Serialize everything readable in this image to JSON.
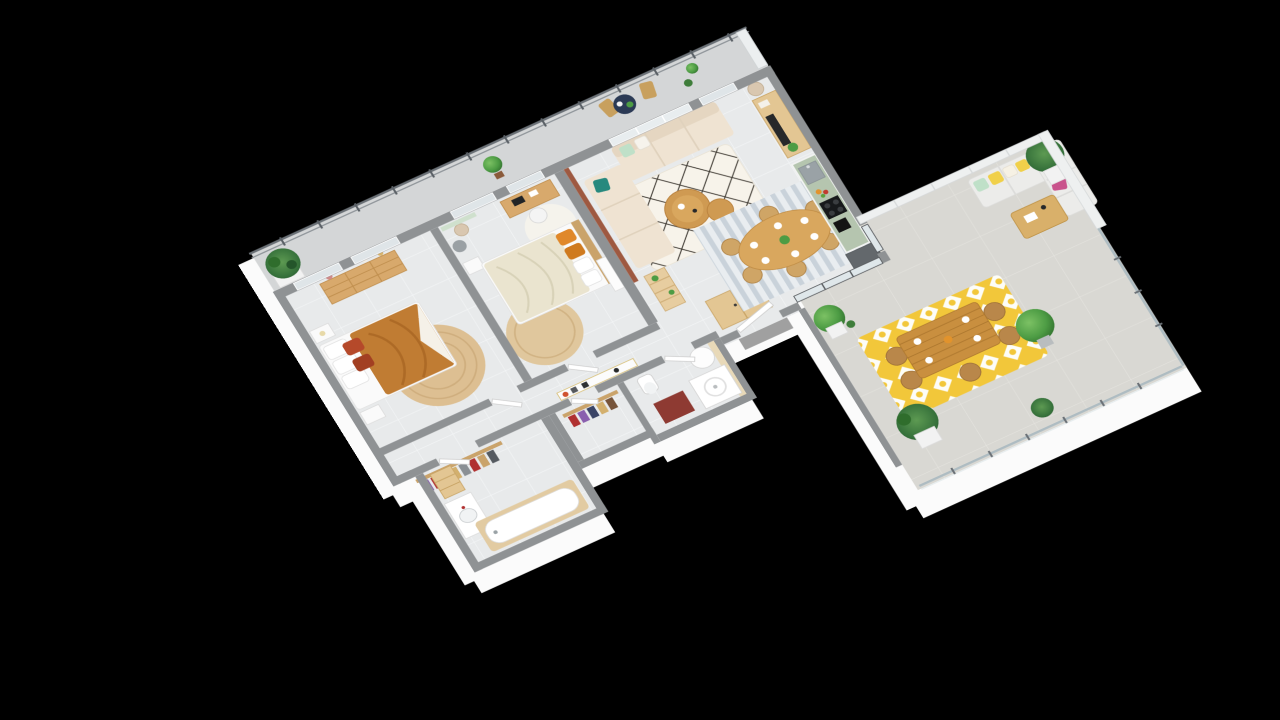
{
  "scene": {
    "type": "isometric-3d-floor-plan",
    "description": "3D rendered floor plan of a three-bedroom apartment with balcony and large terrace on a black background",
    "background": "#000000"
  },
  "palette": {
    "background": "#000000",
    "wallTop": "#8f9294",
    "wallFace": "#fbfbfb",
    "accentWall": "#9e5941",
    "floorMain": "#e8eaeb",
    "floorBalcony": "#d4d6d7",
    "floorTerrace": "#d9d8d3",
    "glass": "#dfe7ea",
    "railingMetal": "#6a7076",
    "screenWhite": "#eef0f0",
    "woodMain": "#d8a96c",
    "woodLight": "#e3c693",
    "woodTable": "#cf9a52",
    "sofaCream": "#efe3d2",
    "outdoorSofa": "#ececea",
    "bedCaramel": "#c07c33",
    "bedLinen": "#eae4cf",
    "pillowRust": "#b5492a",
    "pillowOrange": "#e0882a",
    "pillowTeal": "#27897e",
    "pillowMint": "#bfe0c8",
    "pillowMagenta": "#c9538c",
    "pillowYellow": "#f0d04a",
    "rugJute": "#ddbf92",
    "rugBerber": "#f7f3ea",
    "rugBerberLine": "#332e27",
    "rugStripeA": "#c9d2da",
    "rugStripeB": "#e9edf0",
    "rugYellow": "#f2c73a",
    "kitchenGreen": "#b5c5af",
    "steel": "#9aa2a6",
    "applianceDark": "#17191b",
    "fridgeGray": "#63686c",
    "matRed": "#8e3a32",
    "tileBeige": "#e8d9b8",
    "plantGreen": "#4d9c44",
    "plantDark": "#2f6d2c",
    "potWhite": "#f2f2f2",
    "doormatGray": "#a0a0a0"
  },
  "rooms": [
    {
      "id": "balcony",
      "label": "balcony",
      "items": [
        "metal railing",
        "palm plant",
        "potted tree",
        "bistro table",
        "two chairs",
        "cactus pots",
        "privacy panel"
      ]
    },
    {
      "id": "bedroom-1",
      "label": "bedroom 1",
      "items": [
        "wood dresser",
        "double bed caramel duvet",
        "rust pillows",
        "two nightstands",
        "round jute rug",
        "windows"
      ]
    },
    {
      "id": "bedroom-2",
      "label": "bedroom 2",
      "items": [
        "double bed linen duvet",
        "orange pillows",
        "desk",
        "office chair",
        "floor lamp",
        "pouf",
        "round jute rug",
        "white rug",
        "nightstand"
      ]
    },
    {
      "id": "living-room",
      "label": "living room",
      "items": [
        "terracotta accent wall",
        "cream sectional sofa",
        "teal pillow",
        "ladder shelf",
        "nesting coffee tables",
        "berber rug",
        "tv sideboard",
        "floor lamp",
        "wardrobe"
      ]
    },
    {
      "id": "dining-area",
      "label": "dining area",
      "items": [
        "oval wood table",
        "six rattan chairs",
        "striped rug",
        "place settings",
        "plant centerpiece"
      ]
    },
    {
      "id": "kitchen",
      "label": "kitchen",
      "items": [
        "green counter",
        "sink",
        "hob",
        "coffee machine",
        "fruit bowl",
        "fridge"
      ]
    },
    {
      "id": "hallway",
      "label": "hallway",
      "items": [
        "console table with frames"
      ]
    },
    {
      "id": "dressing",
      "label": "dressing areas",
      "items": [
        "clothes racks with hanging clothes"
      ]
    },
    {
      "id": "bathroom",
      "label": "bathroom",
      "items": [
        "bathtub wood panel",
        "sink counter",
        "shelf unit"
      ]
    },
    {
      "id": "shower-room",
      "label": "shower room",
      "items": [
        "shower tray",
        "toilet",
        "water heater",
        "red mat",
        "tiled wall"
      ]
    },
    {
      "id": "entry",
      "label": "entry",
      "items": [
        "front door",
        "gray doormat"
      ]
    },
    {
      "id": "terrace",
      "label": "terrace",
      "items": [
        "outdoor dining table",
        "rattan chairs",
        "yellow patterned rug",
        "white outdoor corner sofa",
        "colorful pillows",
        "slatted coffee table",
        "potted trees",
        "palm plants",
        "glass railing",
        "privacy screens"
      ]
    }
  ]
}
